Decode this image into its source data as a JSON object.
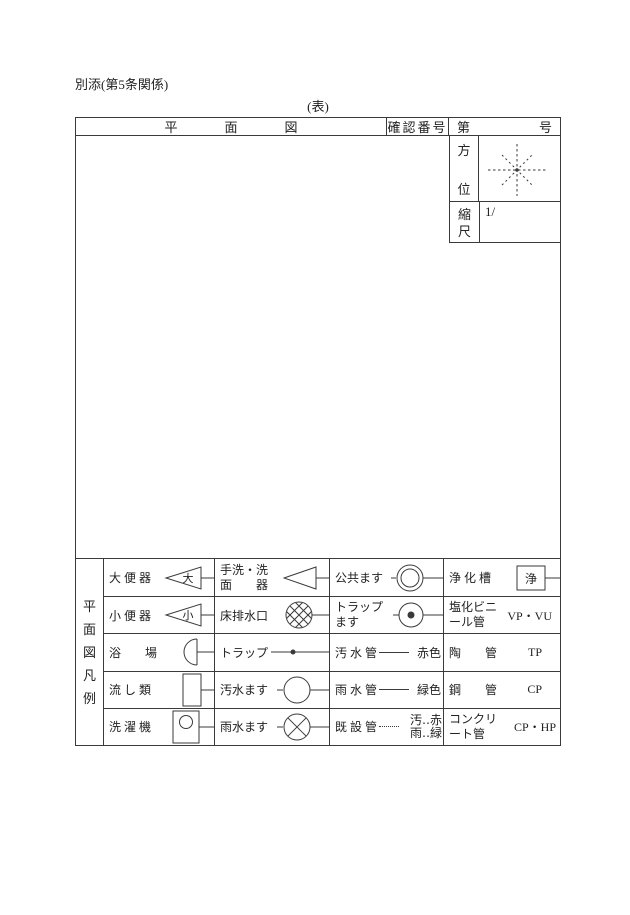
{
  "colors": {
    "ink": "#3a3a3a",
    "paper": "#ffffff"
  },
  "page": {
    "note": "別添(第5条関係)",
    "table_caption": "(表)"
  },
  "header": {
    "title_chars": [
      "平",
      "面",
      "図"
    ],
    "confirm_label": "確認番号",
    "number_prefix": "第",
    "number_suffix": "号"
  },
  "orientation": {
    "label_chars": [
      "方",
      "位"
    ],
    "compass_icon": "dashed-eight-point-compass-star"
  },
  "scale": {
    "label_chars": [
      "縮",
      "尺"
    ],
    "value": "1/"
  },
  "legend": {
    "side_label_chars": [
      "平",
      "面",
      "図",
      "凡",
      "例"
    ],
    "rows": [
      {
        "cells": [
          {
            "label": "大 便 器",
            "symbol": "left-triangle-with-tail",
            "symbol_text": "大"
          },
          {
            "label": "手洗・洗",
            "label2": "面　　器",
            "symbol": "left-triangle-with-tail"
          },
          {
            "label": "公共ます",
            "symbol": "double-circle-with-lines"
          },
          {
            "label": "浄 化 槽",
            "symbol": "labeled-box-with-tail",
            "symbol_text": "浄"
          }
        ]
      },
      {
        "cells": [
          {
            "label": "小 便 器",
            "symbol": "left-triangle-with-tail",
            "symbol_text": "小"
          },
          {
            "label": "床排水口",
            "symbol": "crosshatch-circle-with-tail"
          },
          {
            "label": "トラップ",
            "label2": "ます",
            "symbol": "dot-circle-with-lines"
          },
          {
            "label": "塩化ビニ",
            "label2": "ール管",
            "suffix": "VP・VU"
          }
        ]
      },
      {
        "cells": [
          {
            "label": "浴　　場",
            "symbol": "half-circle-with-tail"
          },
          {
            "label": "トラップ",
            "symbol": "line-with-dot"
          },
          {
            "label": "汚 水 管",
            "symbol": "solid-line",
            "suffix": "赤色"
          },
          {
            "label": "陶　　管",
            "suffix": "TP"
          }
        ]
      },
      {
        "cells": [
          {
            "label": "流 し 類",
            "symbol": "tall-rect-with-tail"
          },
          {
            "label": "汚水ます",
            "symbol": "circle-with-lines"
          },
          {
            "label": "雨 水 管",
            "symbol": "solid-line",
            "suffix": "緑色"
          },
          {
            "label": "鋼　　管",
            "suffix": "CP"
          }
        ]
      },
      {
        "cells": [
          {
            "label": "洗 濯 機",
            "symbol": "rect-with-circle-and-tail"
          },
          {
            "label": "雨水ます",
            "symbol": "x-circle-with-lines"
          },
          {
            "label": "既 設 管",
            "symbol": "dotted-line",
            "suffix_lines": [
              "汚‥赤",
              "雨‥緑"
            ]
          },
          {
            "label": "コンクリ",
            "label2": "ート管",
            "suffix": "CP・HP"
          }
        ]
      }
    ]
  }
}
